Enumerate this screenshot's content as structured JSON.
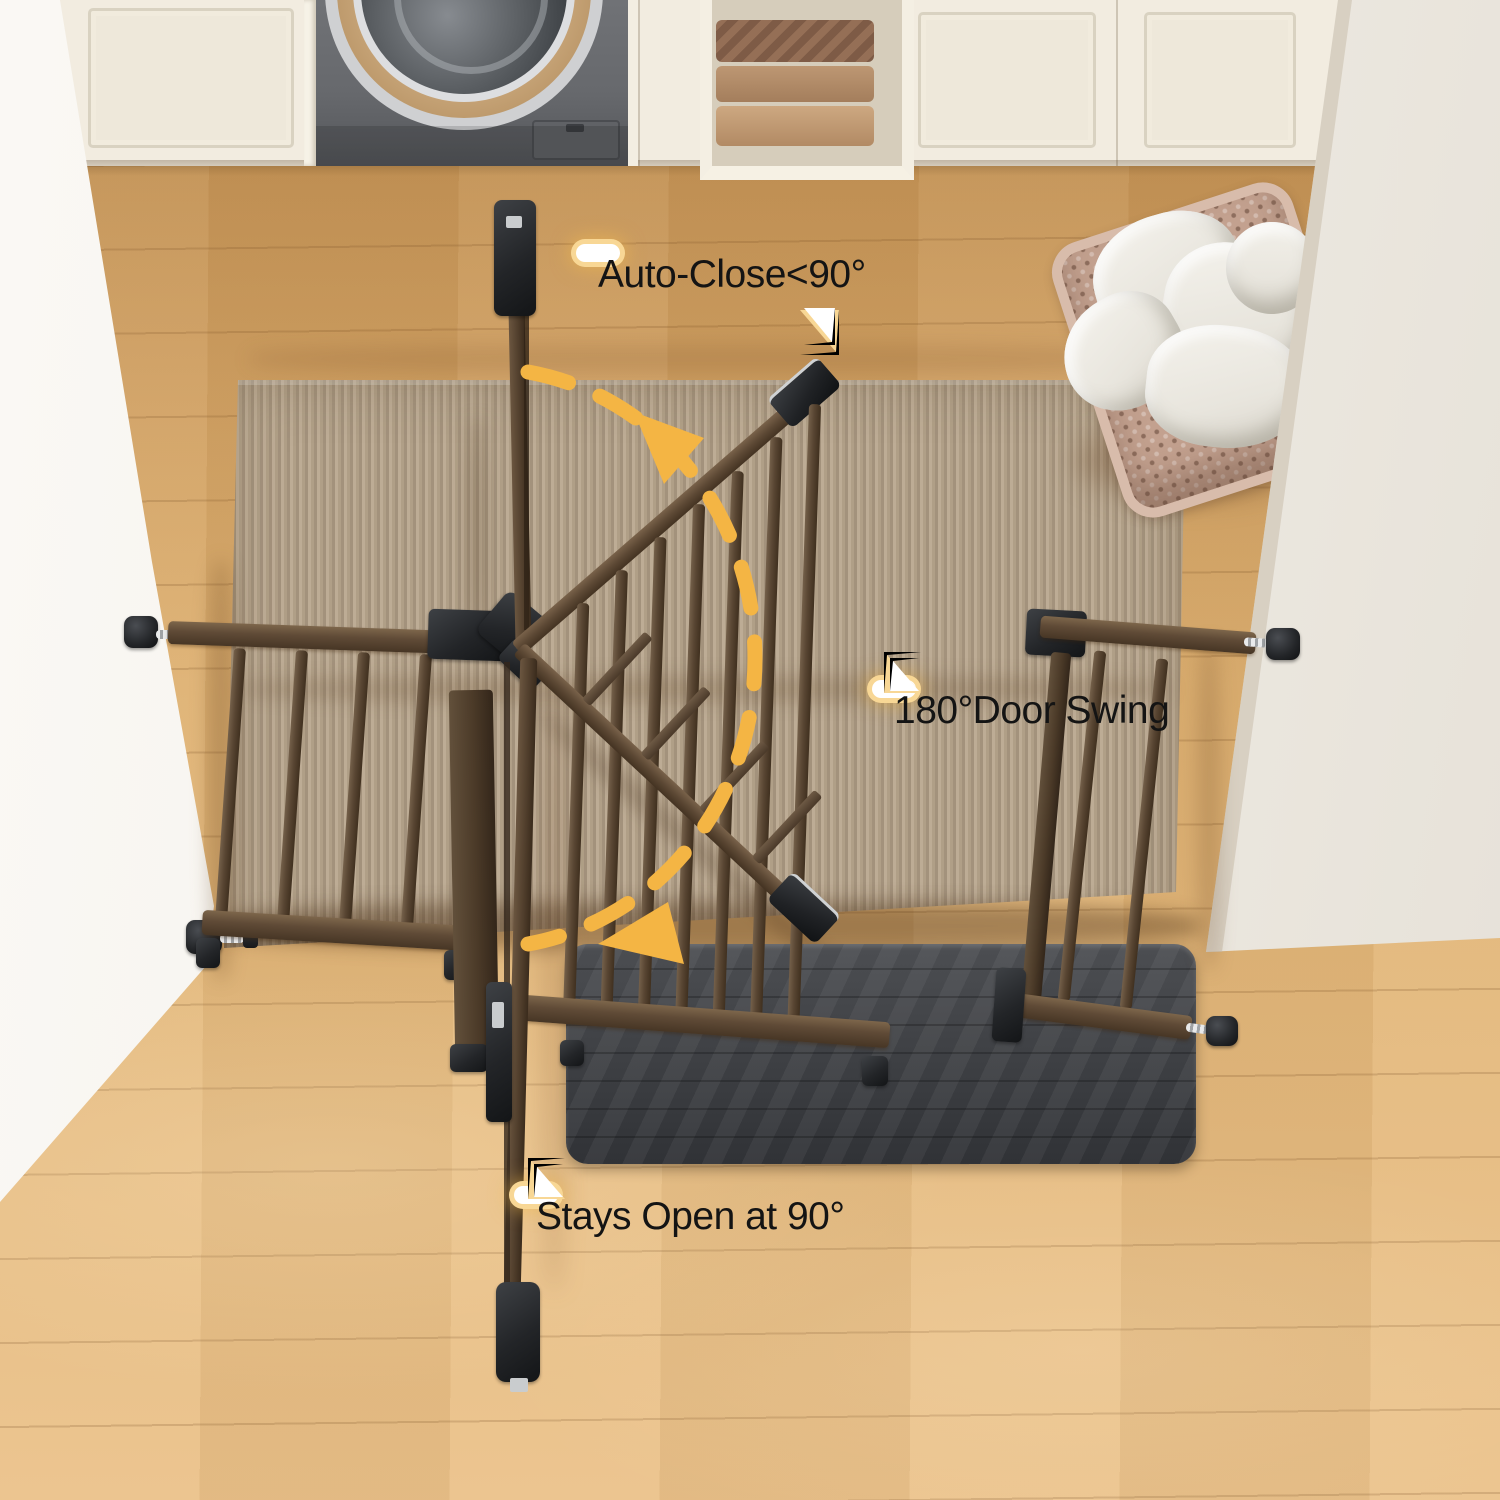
{
  "scene": {
    "annotations": {
      "auto_close": "Auto-Close<90°",
      "door_swing": "180°Door Swing",
      "stays_open": "Stays Open at 90°"
    },
    "colors": {
      "accent_amber": "#F4B544",
      "gate_brown": "#5A4632",
      "gate_black": "#232528",
      "rug_beige": "#B3A18C",
      "floor_oak": "#DDAE70",
      "wall_white": "#F2EEE7",
      "mat_gray": "#45474A",
      "basket_tan": "#C3A18F"
    },
    "objects": [
      "wood-floor",
      "area-rug",
      "door-mat",
      "safety-gate",
      "swing-arc-arrow",
      "washing-machine",
      "cabinets",
      "towel-shelf",
      "laundry-basket",
      "left-wall",
      "right-wall"
    ]
  }
}
